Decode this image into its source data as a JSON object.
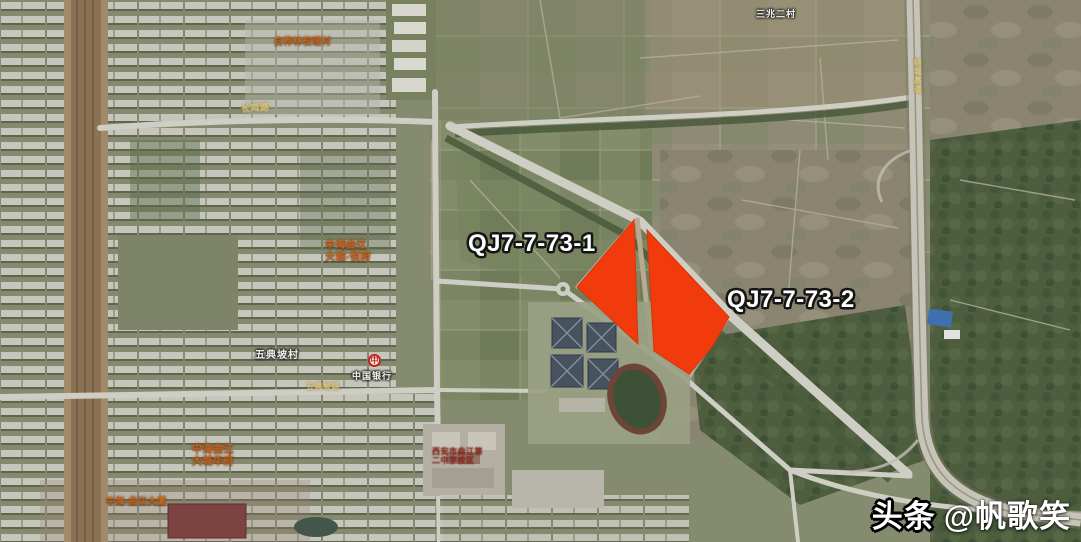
{
  "map": {
    "parcels": [
      {
        "label": "QJ7-7-73-1"
      },
      {
        "label": "QJ7-7-73-2"
      }
    ],
    "parcel_color": "#f23b0d",
    "labels": {
      "compound_top": "白桦林校理村",
      "road_nw": "长鸣路",
      "compound_mid_1": "中海曲江",
      "compound_mid_2": "大城·悦府",
      "village_w": "五典坡村",
      "bank": "中国银行",
      "bank_logo": "中",
      "compound_sw_1": "中海曲江",
      "compound_sw_2": "大城华府",
      "tower_sw": "中海·曲江大厦",
      "school_1": "西安市曲江第",
      "school_2": "二中学校区",
      "village_ne": "三兆二村",
      "highway_e": "绕城高速",
      "road_s": "五典坡路"
    },
    "watermark": {
      "brand": "头条",
      "handle": "@帆歌笑"
    }
  }
}
